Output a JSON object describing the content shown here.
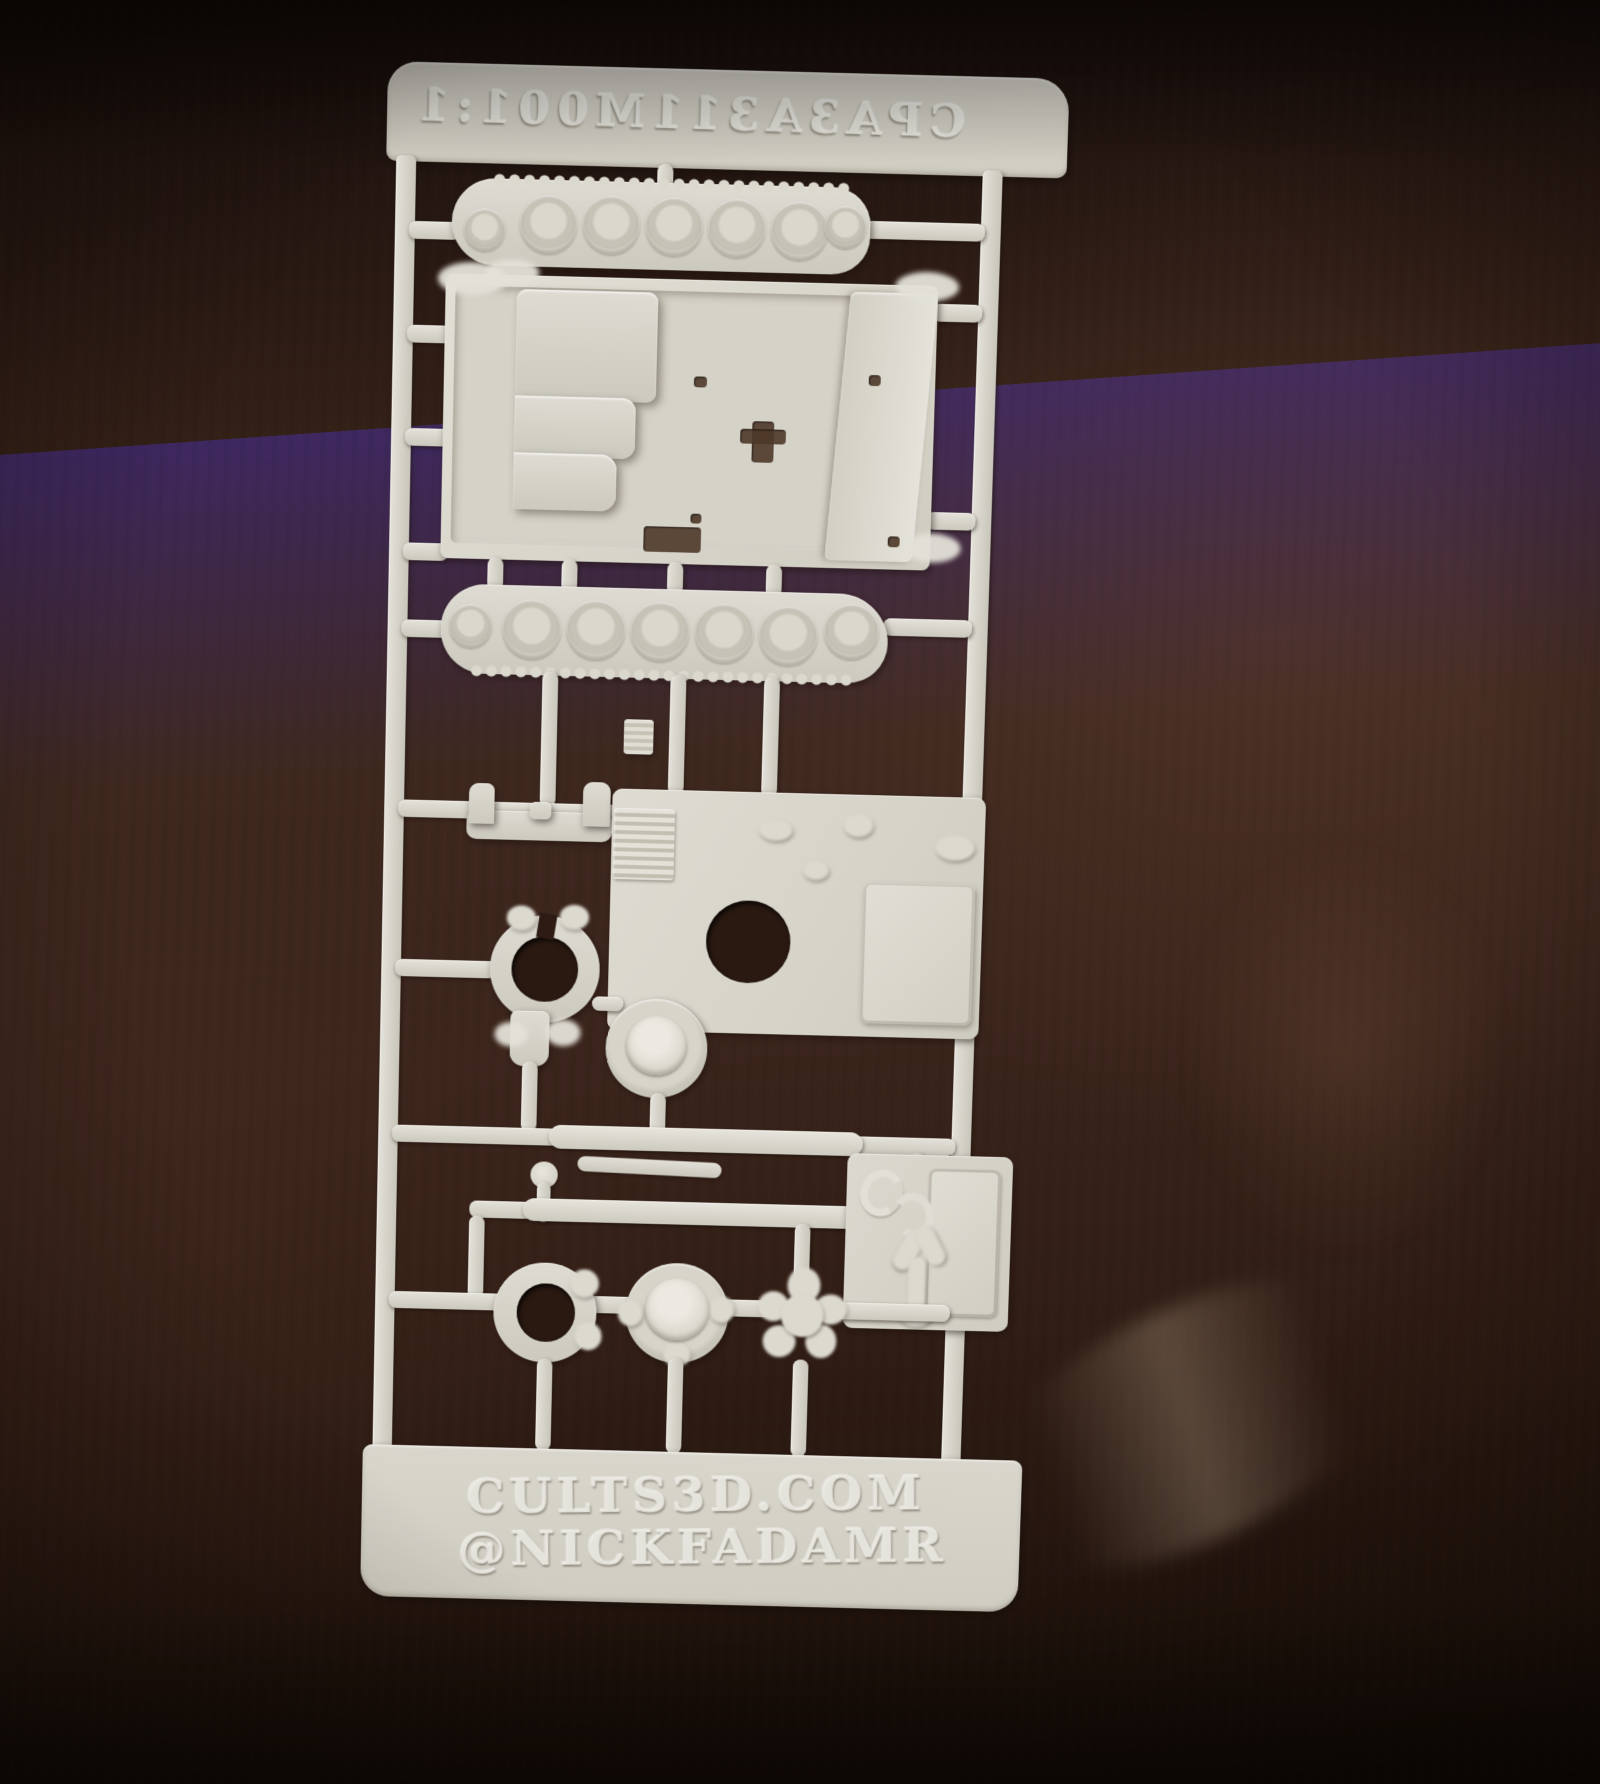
{
  "photo": {
    "subject": "white 3D-printed model kit sprue photographed on a dark wooden table",
    "sprue": {
      "title_embossed_mirrored": "1:100 M113 A3 APC",
      "footer_site": "CULTS3D.COM",
      "footer_handle": "@NICKFADAMR",
      "parts": [
        {
          "id": "track-run-upper",
          "label": "track run with road wheels (upper)"
        },
        {
          "id": "lower-hull-tub",
          "label": "lower hull tub with engine bay and floor holes"
        },
        {
          "id": "track-run-lower",
          "label": "track run with road wheels (lower)"
        },
        {
          "id": "trim-vane-bracket",
          "label": "small U-shaped bracket"
        },
        {
          "id": "top-deck-plate",
          "label": "top deck plate with grille, round hatch opening and cargo hatch"
        },
        {
          "id": "mg-ring-mount",
          "label": "open machine-gun ring mount with tab"
        },
        {
          "id": "hatch-dome-small",
          "label": "small round hatch dome"
        },
        {
          "id": "rod-long",
          "label": "long thin rod"
        },
        {
          "id": "rod-short",
          "label": "short thin rod"
        },
        {
          "id": "post-with-ball",
          "label": "short post with ball end"
        },
        {
          "id": "ring-open-lower",
          "label": "open ring (lower left)"
        },
        {
          "id": "hatch-dome-large",
          "label": "round hatch dome with scalloped rim"
        },
        {
          "id": "star-cluster",
          "label": "multi-pronged small part"
        },
        {
          "id": "rear-ramp-door",
          "label": "rear ramp plate with door and small fittings"
        }
      ]
    },
    "colors": {
      "plastic": "#d7d4ca",
      "plastic_light": "#e7e5dc",
      "plastic_shade": "#b9b6aa",
      "wood_dark": "#1a100a",
      "wood_mid": "#38221a",
      "wood_warm": "#4d3126",
      "hole": "#2a1911"
    }
  }
}
